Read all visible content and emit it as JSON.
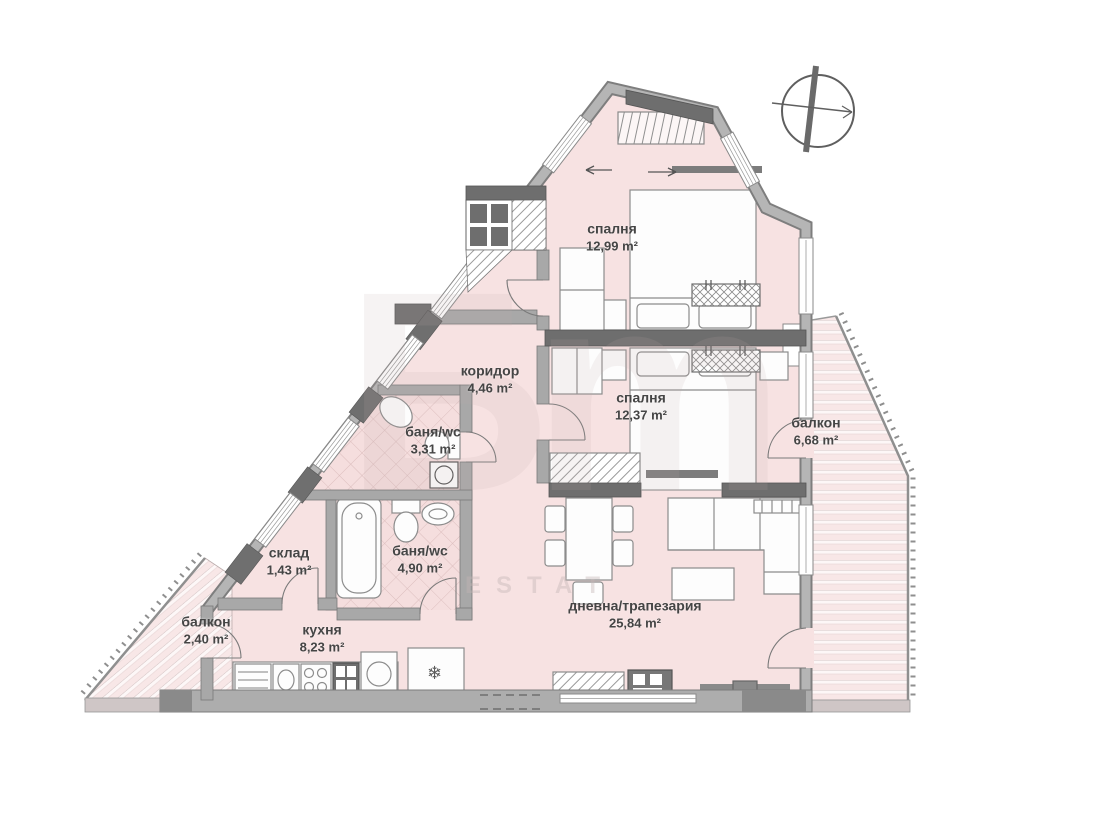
{
  "plan": {
    "rooms": [
      {
        "id": "bedroom-top",
        "name": "спалня",
        "area": "12,99 m²"
      },
      {
        "id": "corridor",
        "name": "коридор",
        "area": "4,46 m²"
      },
      {
        "id": "bathroom-1",
        "name": "баня/wc",
        "area": "3,31 m²"
      },
      {
        "id": "bedroom-mid",
        "name": "спалня",
        "area": "12,37 m²"
      },
      {
        "id": "balcony-right",
        "name": "балкон",
        "area": "6,68 m²"
      },
      {
        "id": "storage",
        "name": "склад",
        "area": "1,43 m²"
      },
      {
        "id": "bathroom-2",
        "name": "баня/wc",
        "area": "4,90 m²"
      },
      {
        "id": "living-dining",
        "name": "дневна/трапезария",
        "area": "25,84 m²"
      },
      {
        "id": "balcony-left",
        "name": "балкон",
        "area": "2,40 m²"
      },
      {
        "id": "kitchen",
        "name": "кухня",
        "area": "8,23 m²"
      }
    ],
    "watermark": {
      "glyphs": "Бm",
      "text": "ESTAT"
    },
    "symbols": {
      "freezer": "❄"
    },
    "colors": {
      "floor": "#f7e2e2",
      "wall": "#a8a8a8",
      "wall_dark": "#6e6e6e",
      "label": "#454545"
    }
  }
}
